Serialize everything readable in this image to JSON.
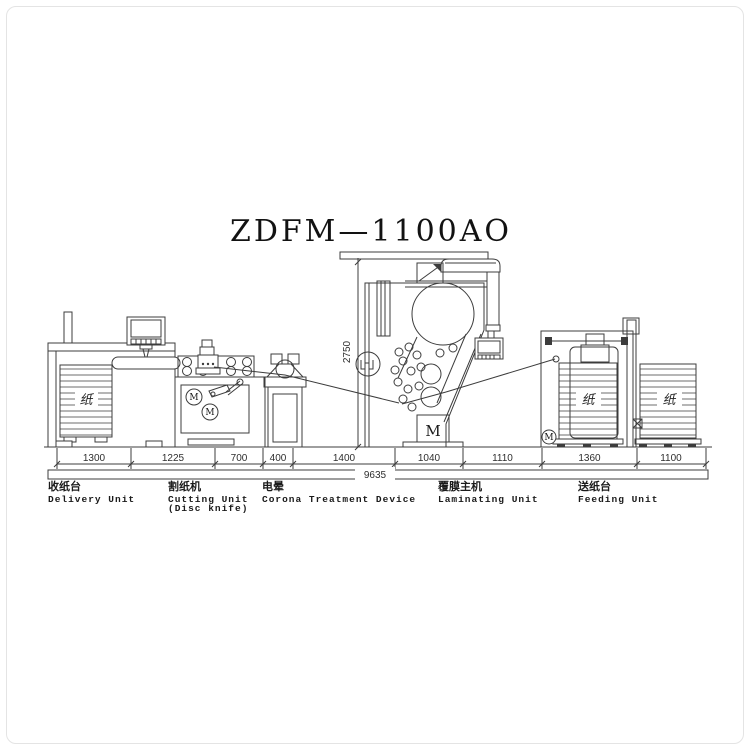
{
  "page": {
    "title": "ZDFM—1100AO"
  },
  "units": [
    {
      "zh": "收纸台",
      "en": "Delivery Unit",
      "en2": ""
    },
    {
      "zh": "割纸机",
      "en": "Cutting Unit",
      "en2": "(Disc knife)"
    },
    {
      "zh": "电晕",
      "en": "Corona Treatment Device",
      "en2": ""
    },
    {
      "zh": "覆膜主机",
      "en": "Laminating Unit",
      "en2": ""
    },
    {
      "zh": "送纸台",
      "en": "Feeding Unit",
      "en2": ""
    }
  ],
  "dimensions": {
    "segments": [
      "1300",
      "1225",
      "700",
      "400",
      "1400",
      "1040",
      "1110",
      "1360",
      "1100"
    ],
    "total": "9635",
    "height": "2750"
  },
  "annotations": {
    "paper": "纸",
    "motor": "M"
  }
}
